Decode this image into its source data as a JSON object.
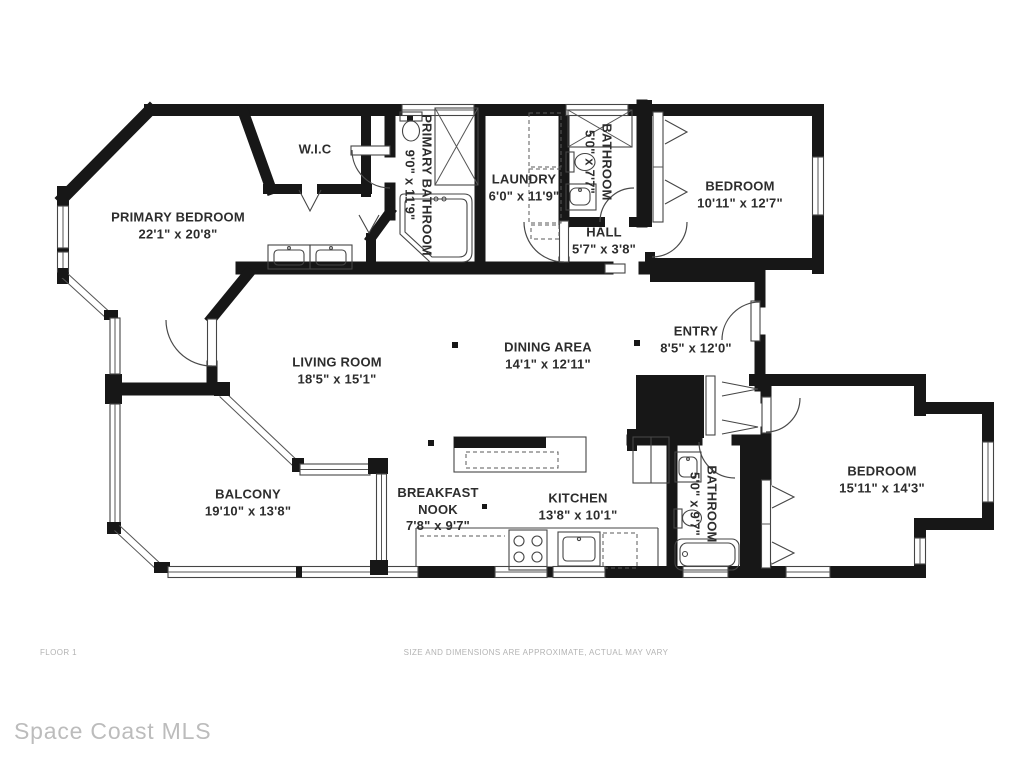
{
  "rooms": {
    "wic": {
      "name": "W.I.C"
    },
    "primary_bedroom": {
      "name": "PRIMARY BEDROOM",
      "dims": "22'1\" x 20'8\""
    },
    "primary_bathroom": {
      "name": "PRIMARY BATHROOM",
      "dims": "9'0\" x 11'9\""
    },
    "laundry": {
      "name": "LAUNDRY",
      "dims": "6'0\" x 11'9\""
    },
    "bathroom_top": {
      "name": "BATHROOM",
      "dims": "5'0\" x 7'7\""
    },
    "bedroom_top": {
      "name": "BEDROOM",
      "dims": "10'11\" x 12'7\""
    },
    "hall": {
      "name": "HALL",
      "dims": "5'7\" x 3'8\""
    },
    "living_room": {
      "name": "LIVING ROOM",
      "dims": "18'5\" x 15'1\""
    },
    "dining_area": {
      "name": "DINING AREA",
      "dims": "14'1\" x 12'11\""
    },
    "entry": {
      "name": "ENTRY",
      "dims": "8'5\" x 12'0\""
    },
    "balcony": {
      "name": "BALCONY",
      "dims": "19'10\" x 13'8\""
    },
    "breakfast_nook": {
      "name": "BREAKFAST NOOK",
      "dims": "7'8\" x 9'7\""
    },
    "kitchen": {
      "name": "KITCHEN",
      "dims": "13'8\" x 10'1\""
    },
    "bathroom_bottom": {
      "name": "BATHROOM",
      "dims": "5'0\" x 9'7\""
    },
    "bedroom_bottom": {
      "name": "BEDROOM",
      "dims": "15'11\" x 14'3\""
    }
  },
  "footer": {
    "floor_label": "FLOOR 1",
    "disclaimer": "SIZE AND DIMENSIONS ARE APPROXIMATE, ACTUAL MAY VARY"
  },
  "watermark": "Space Coast MLS",
  "colors": {
    "wall": "#171717",
    "label_text": "#2d2d2d",
    "muted_text": "#b3b3b3",
    "watermark_text": "#bcbcbc"
  }
}
